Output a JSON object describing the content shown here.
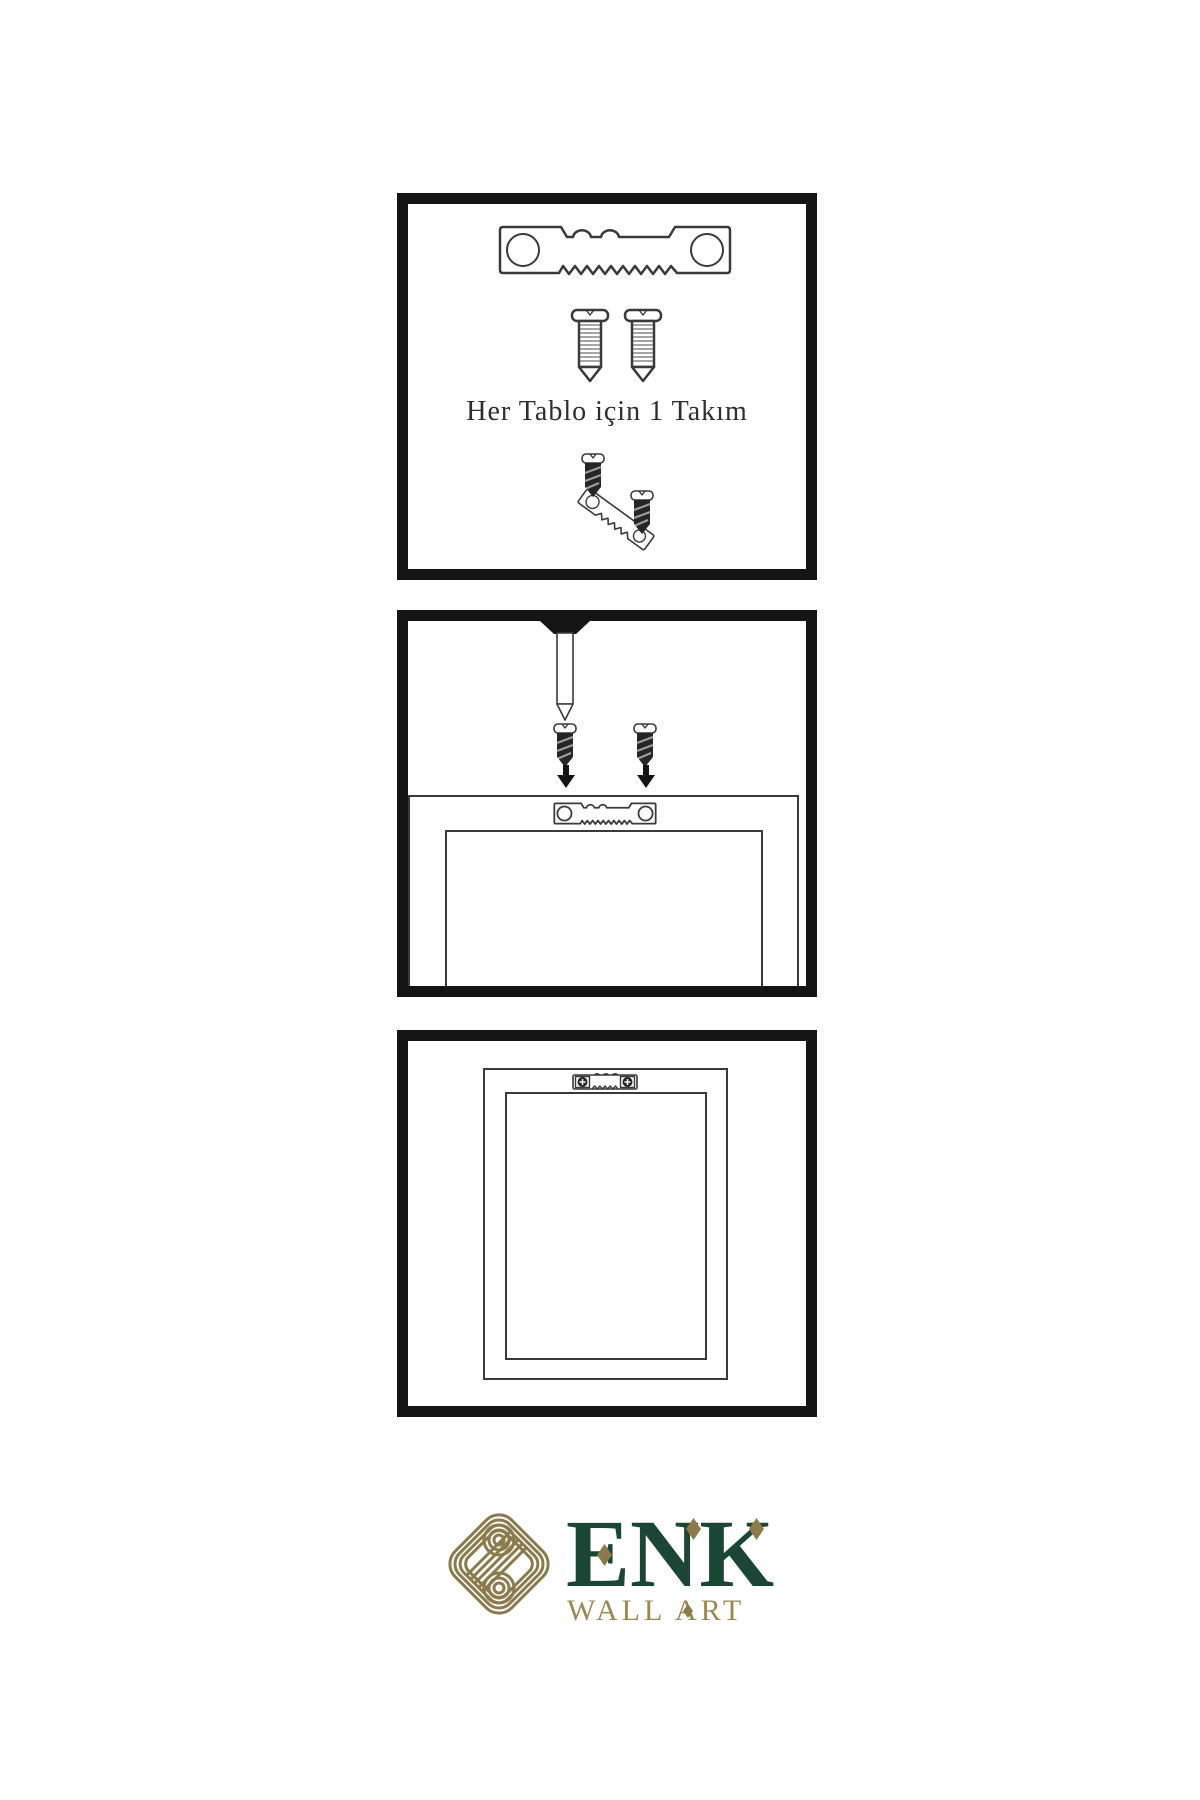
{
  "page": {
    "background": "#ffffff"
  },
  "colors": {
    "panel_border": "#141414",
    "line": "#3a3a3a",
    "dark_fill": "#262626",
    "text": "#2e2e2e",
    "logo_gold": "#8b7a4b",
    "logo_green": "#1c4634",
    "wall_gold": "#9b8753"
  },
  "panel1": {
    "caption": "Her Tablo için 1 Takım",
    "contents": [
      "sawtooth-hanger",
      "screw",
      "screw",
      "small-screw",
      "angled-sawtooth-hanger",
      "small-screw"
    ]
  },
  "panel2": {
    "contents": [
      "wall-nail",
      "dark-screw",
      "dark-screw",
      "down-arrow",
      "down-arrow",
      "frame-back",
      "sawtooth-hanger-mounted"
    ]
  },
  "panel3": {
    "contents": [
      "hung-frame",
      "sawtooth-hanger-with-screws"
    ]
  },
  "logo": {
    "brand": "ENK",
    "subtitle": "WALL ART"
  }
}
